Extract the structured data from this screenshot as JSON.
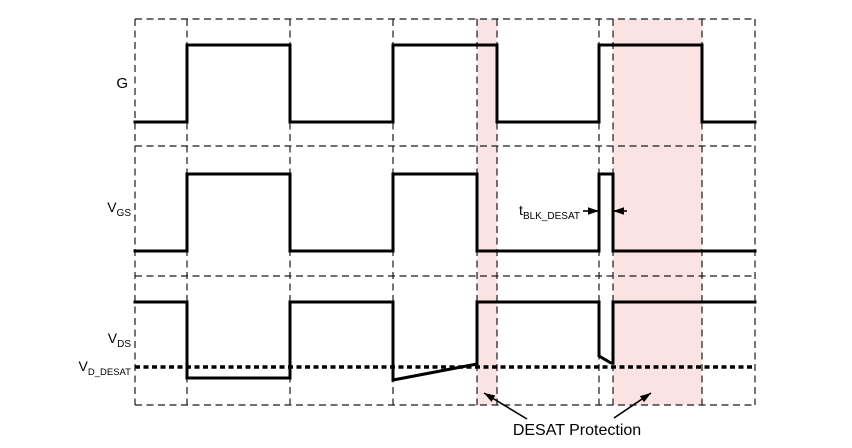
{
  "title": "DESAT Protection timing diagram",
  "colors": {
    "highlight": "#fce3e3",
    "line": "#000000"
  },
  "labels": {
    "g": "G",
    "vgs": {
      "base": "V",
      "sub": "GS"
    },
    "vds": {
      "base": "V",
      "sub": "DS"
    },
    "vd_desat": {
      "base": "V",
      "sub": "D_DESAT"
    },
    "t_blk_desat": {
      "base": "t",
      "sub": "BLK_DESAT"
    },
    "desat_protection": "DESAT Protection"
  },
  "diagram": {
    "plot": {
      "left": 135,
      "right": 755,
      "top": 19,
      "bottom": 405
    },
    "grid": {
      "vertical_x": [
        135,
        187,
        290,
        393,
        477,
        497,
        599,
        613,
        702,
        755
      ],
      "horizontal_y": [
        19,
        146,
        276,
        405
      ]
    },
    "highlight_regions": [
      {
        "name": "desat-event-1",
        "x": 477,
        "width": 20
      },
      {
        "name": "desat-event-2",
        "x": 613,
        "width": 89
      }
    ],
    "threshold": {
      "y": 367,
      "x1": 135,
      "x2": 755
    },
    "waveforms": [
      {
        "name": "G",
        "points": [
          [
            135,
            122
          ],
          [
            187,
            122
          ],
          [
            187,
            45
          ],
          [
            290,
            45
          ],
          [
            290,
            122
          ],
          [
            393,
            122
          ],
          [
            393,
            45
          ],
          [
            497,
            45
          ],
          [
            497,
            122
          ],
          [
            599,
            122
          ],
          [
            599,
            45
          ],
          [
            702,
            45
          ],
          [
            702,
            122
          ],
          [
            755,
            122
          ]
        ]
      },
      {
        "name": "VGS",
        "points": [
          [
            135,
            251
          ],
          [
            187,
            251
          ],
          [
            187,
            174
          ],
          [
            290,
            174
          ],
          [
            290,
            251
          ],
          [
            393,
            251
          ],
          [
            393,
            174
          ],
          [
            477,
            174
          ],
          [
            477,
            251
          ],
          [
            599,
            251
          ],
          [
            599,
            174
          ],
          [
            613,
            174
          ],
          [
            613,
            251
          ],
          [
            755,
            251
          ]
        ]
      },
      {
        "name": "VDS",
        "points": [
          [
            135,
            302
          ],
          [
            187,
            302
          ],
          [
            187,
            378
          ],
          [
            290,
            378
          ],
          [
            290,
            302
          ],
          [
            393,
            302
          ],
          [
            393,
            380
          ],
          [
            477,
            364
          ],
          [
            477,
            302
          ],
          [
            599,
            302
          ],
          [
            599,
            356
          ],
          [
            611,
            363
          ],
          [
            613,
            363
          ],
          [
            613,
            302
          ],
          [
            755,
            302
          ]
        ]
      }
    ],
    "annotations": {
      "t_blk_arrows": [
        {
          "x1": 583,
          "y1": 211,
          "x2": 599,
          "y2": 211
        },
        {
          "x1": 627,
          "y1": 211,
          "x2": 613,
          "y2": 211
        }
      ],
      "desat_arrows": [
        {
          "x1": 527,
          "y1": 419,
          "x2": 484,
          "y2": 393
        },
        {
          "x1": 614,
          "y1": 418,
          "x2": 651,
          "y2": 393
        }
      ]
    }
  }
}
